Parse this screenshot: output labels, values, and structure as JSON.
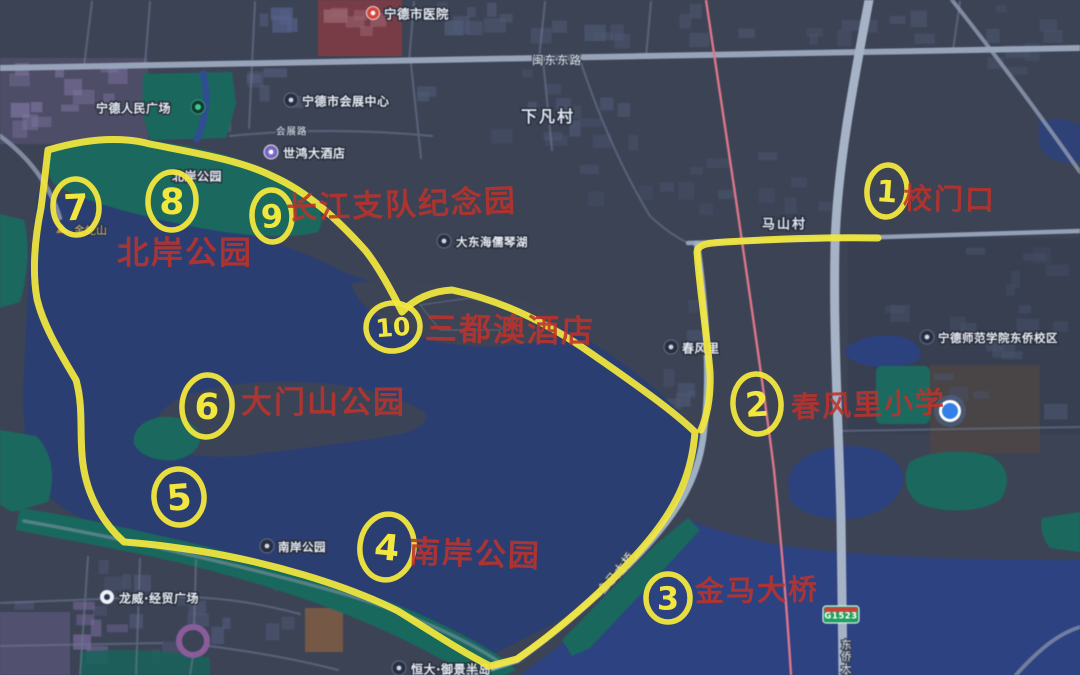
{
  "colors": {
    "land": "#3c4356",
    "water": "#293e74",
    "water_bright": "#2b4284",
    "park_green": "#17695d",
    "road": "#97a3ba",
    "railway": "#e2758a",
    "annotation_yellow": "#f2e73e",
    "annotation_red": "#bc332c",
    "label_white": "#e8edf5",
    "badge_green": "#1ca05b",
    "location_blue": "#2f80ec"
  },
  "poi_labels": [
    {
      "name": "ningde-hospital",
      "text": "宁德市医院",
      "x": 384,
      "y": 14,
      "size": 12.5,
      "icon": "red-pin",
      "ix": 373,
      "iy": 13
    },
    {
      "name": "renmin-square",
      "text": "宁德人民广场",
      "x": 96,
      "y": 108,
      "size": 12,
      "icon": "green-dot",
      "ix": 198,
      "iy": 107
    },
    {
      "name": "convention-center",
      "text": "宁德市会展中心",
      "x": 302,
      "y": 101,
      "size": 12,
      "icon": "dark",
      "ix": 291,
      "iy": 100
    },
    {
      "name": "shihong-hotel",
      "text": "世鸿大酒店",
      "x": 283,
      "y": 153,
      "size": 12,
      "icon": "purple",
      "ix": 271,
      "iy": 152
    },
    {
      "name": "xiafan-village",
      "text": "下凡村",
      "x": 521,
      "y": 116,
      "size": 16,
      "cls": "biglabel"
    },
    {
      "name": "beian-park-map",
      "text": "北岸公园",
      "x": 172,
      "y": 176,
      "size": 12
    },
    {
      "name": "jinshe-hill",
      "text": "金蛇山",
      "x": 74,
      "y": 230,
      "size": 11,
      "cls": "hill",
      "icon": "mountain",
      "ix": 62,
      "iy": 229
    },
    {
      "name": "dadonghai-lake",
      "text": "大东海儒琴湖",
      "x": 456,
      "y": 242,
      "size": 11.5,
      "icon": "dark",
      "ix": 444,
      "iy": 241
    },
    {
      "name": "mashan-village",
      "text": "马山村",
      "x": 762,
      "y": 224,
      "size": 13,
      "cls": "biglabel"
    },
    {
      "name": "normal-university",
      "text": "宁德师范学院东侨校区",
      "x": 938,
      "y": 338,
      "size": 11.5,
      "icon": "dark",
      "ix": 927,
      "iy": 337
    },
    {
      "name": "chunfengli",
      "text": "春风里",
      "x": 682,
      "y": 348,
      "size": 12,
      "icon": "dark",
      "ix": 671,
      "iy": 347
    },
    {
      "name": "nanan-park-map",
      "text": "南岸公园",
      "x": 278,
      "y": 547,
      "size": 11.5,
      "icon": "dark",
      "ix": 267,
      "iy": 546
    },
    {
      "name": "longwei-plaza",
      "text": "龙威·经贸广场",
      "x": 119,
      "y": 598,
      "size": 12,
      "icon": "white",
      "ix": 107,
      "iy": 597
    },
    {
      "name": "hengda-estate",
      "text": "恒大·御景半岛",
      "x": 411,
      "y": 669,
      "size": 12,
      "icon": "dark",
      "ix": 399,
      "iy": 668
    }
  ],
  "road_labels": [
    {
      "name": "mindong-east-road",
      "text": "闽东东路",
      "x": 532,
      "y": 60,
      "size": 11.5
    },
    {
      "name": "huizhan-road",
      "text": "会展路",
      "x": 276,
      "y": 131,
      "size": 9.5
    },
    {
      "name": "jinma-bridge-road",
      "text": "金马大桥",
      "x": 600,
      "y": 592,
      "size": 11.5,
      "rotate": -50
    },
    {
      "name": "dongqiao-bridge-road",
      "text": "东侨大桥",
      "x": 841,
      "y": 648,
      "size": 10.5,
      "vertical": true
    }
  ],
  "badges": [
    {
      "name": "g1523",
      "text": "G1523",
      "x": 823,
      "y": 606,
      "w": 36,
      "h": 17
    }
  ],
  "annotations": {
    "texts": [
      {
        "name": "school-gate",
        "text": "校门口",
        "x": 903,
        "y": 198,
        "size": 29,
        "rotate": 1
      },
      {
        "name": "changjiang-memorial",
        "text": "长江支队纪念园",
        "x": 286,
        "y": 208,
        "size": 31,
        "rotate": -2
      },
      {
        "name": "beian-park",
        "text": "北岸公园",
        "x": 117,
        "y": 252,
        "size": 32,
        "rotate": 0
      },
      {
        "name": "sanduao-hotel",
        "text": "三都澳酒店",
        "x": 425,
        "y": 328,
        "size": 32,
        "rotate": 1
      },
      {
        "name": "damenshan-park",
        "text": "大门山公园",
        "x": 241,
        "y": 402,
        "size": 31,
        "rotate": 0
      },
      {
        "name": "nanan-park",
        "text": "南岸公园",
        "x": 409,
        "y": 551,
        "size": 31,
        "rotate": 2
      },
      {
        "name": "jinma-bridge",
        "text": "金马大桥",
        "x": 695,
        "y": 591,
        "size": 29,
        "rotate": -1
      },
      {
        "name": "chunfengli-school",
        "text": "春风里小学",
        "x": 791,
        "y": 407,
        "size": 29,
        "rotate": -2
      }
    ],
    "circles": [
      {
        "num": "1",
        "cx": 887,
        "cy": 191,
        "rx": 20,
        "ry": 26,
        "rot": 6,
        "fs": 30
      },
      {
        "num": "2",
        "cx": 757,
        "cy": 404,
        "rx": 24,
        "ry": 30,
        "rot": -5,
        "fs": 34
      },
      {
        "num": "3",
        "cx": 668,
        "cy": 598,
        "rx": 22,
        "ry": 24,
        "rot": 0,
        "fs": 32
      },
      {
        "num": "4",
        "cx": 387,
        "cy": 547,
        "rx": 27,
        "ry": 33,
        "rot": 8,
        "fs": 36
      },
      {
        "num": "5",
        "cx": 179,
        "cy": 497,
        "rx": 25,
        "ry": 28,
        "rot": -6,
        "fs": 36
      },
      {
        "num": "6",
        "cx": 207,
        "cy": 406,
        "rx": 25,
        "ry": 31,
        "rot": 5,
        "fs": 36
      },
      {
        "num": "7",
        "cx": 76,
        "cy": 207,
        "rx": 23,
        "ry": 28,
        "rot": -4,
        "fs": 36
      },
      {
        "num": "8",
        "cx": 172,
        "cy": 201,
        "rx": 24,
        "ry": 29,
        "rot": 3,
        "fs": 36
      },
      {
        "num": "9",
        "cx": 272,
        "cy": 216,
        "rx": 20,
        "ry": 26,
        "rot": -3,
        "fs": 32
      },
      {
        "num": "10",
        "cx": 393,
        "cy": 327,
        "rx": 27,
        "ry": 24,
        "rot": -6,
        "fs": 25
      }
    ],
    "routes": [
      {
        "name": "loop-route",
        "d": "M48,150 C85,139 120,136 150,144 C195,153 240,160 272,176 C308,192 338,220 365,250 C378,266 392,292 402,312 C414,299 432,291 452,290 C500,300 548,323 592,354 C632,382 670,408 695,432 C692,472 678,505 649,540 C616,580 562,628 517,659 L490,666 C462,652 432,632 398,611 C344,584 268,562 199,551 C168,546 140,543 124,542 C101,521 87,494 83,464 C79,437 84,408 76,380 C62,356 44,328 37,299 C32,271 35,238 41,208 C44,186 46,166 48,150 Z"
      },
      {
        "name": "gate-route",
        "d": "M878,238 C830,237 775,239 725,242 C708,243 698,244 697,252 C700,292 707,335 710,372 C711,397 707,416 701,430"
      }
    ]
  },
  "location_dot": {
    "x": 950,
    "y": 411
  }
}
